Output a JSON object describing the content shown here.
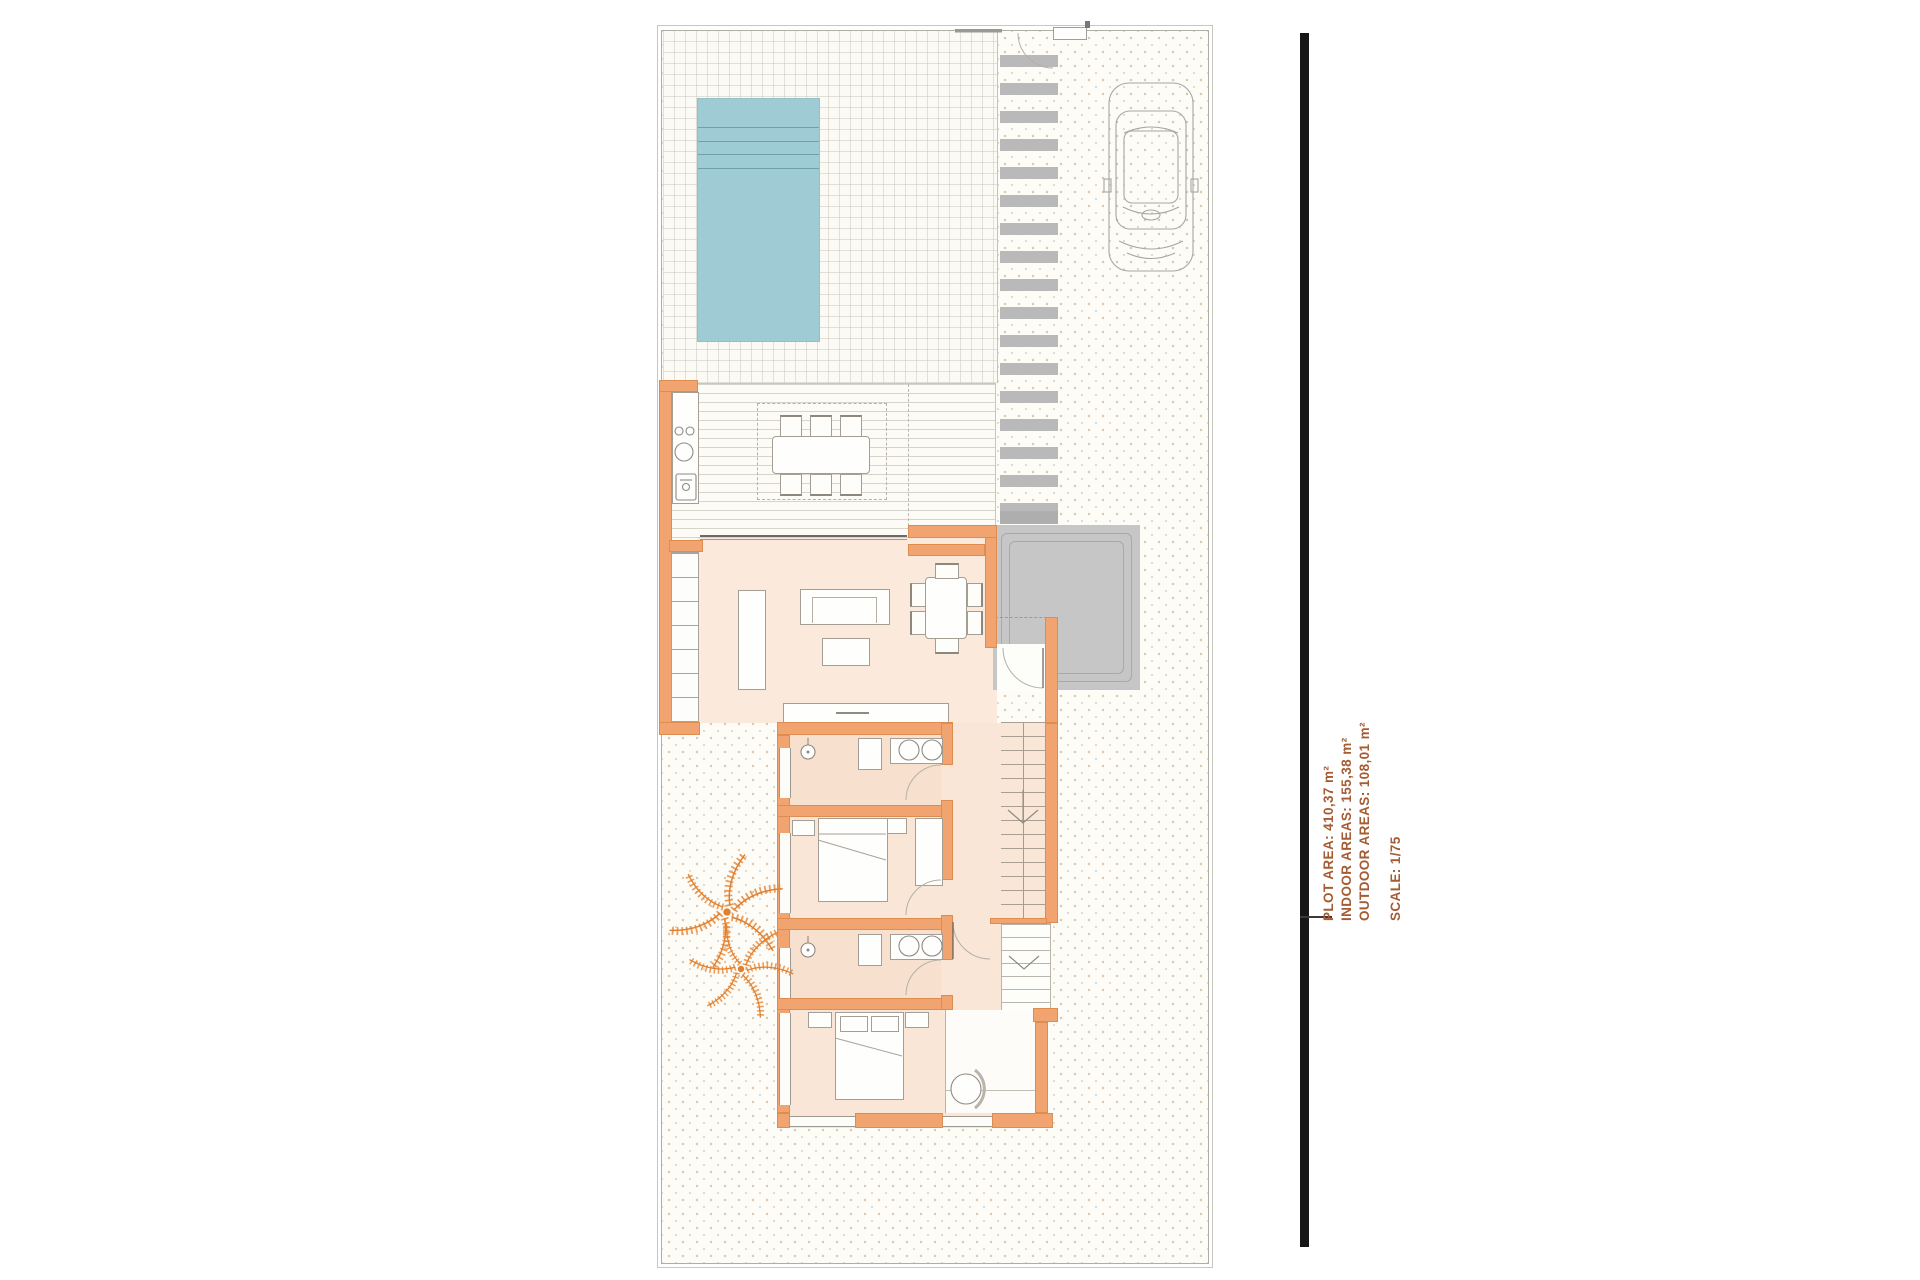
{
  "annotation": {
    "lines": [
      "PLOT AREA: 410,37 m²",
      "INDOOR AREAS: 155,38 m²",
      "OUTDOOR AREAS: 108,01 m²"
    ],
    "scale": "SCALE: 1/75"
  },
  "colors": {
    "wall": "#f1a46f",
    "pool": "#9fccd4",
    "anno": "#a55c33",
    "garage": "#c6c6c6",
    "paver": "#b9b9b9",
    "floor": "#fbe9dc",
    "floor2": "#f9e6d7",
    "palm": "#e8883c",
    "bar": "#161616"
  }
}
